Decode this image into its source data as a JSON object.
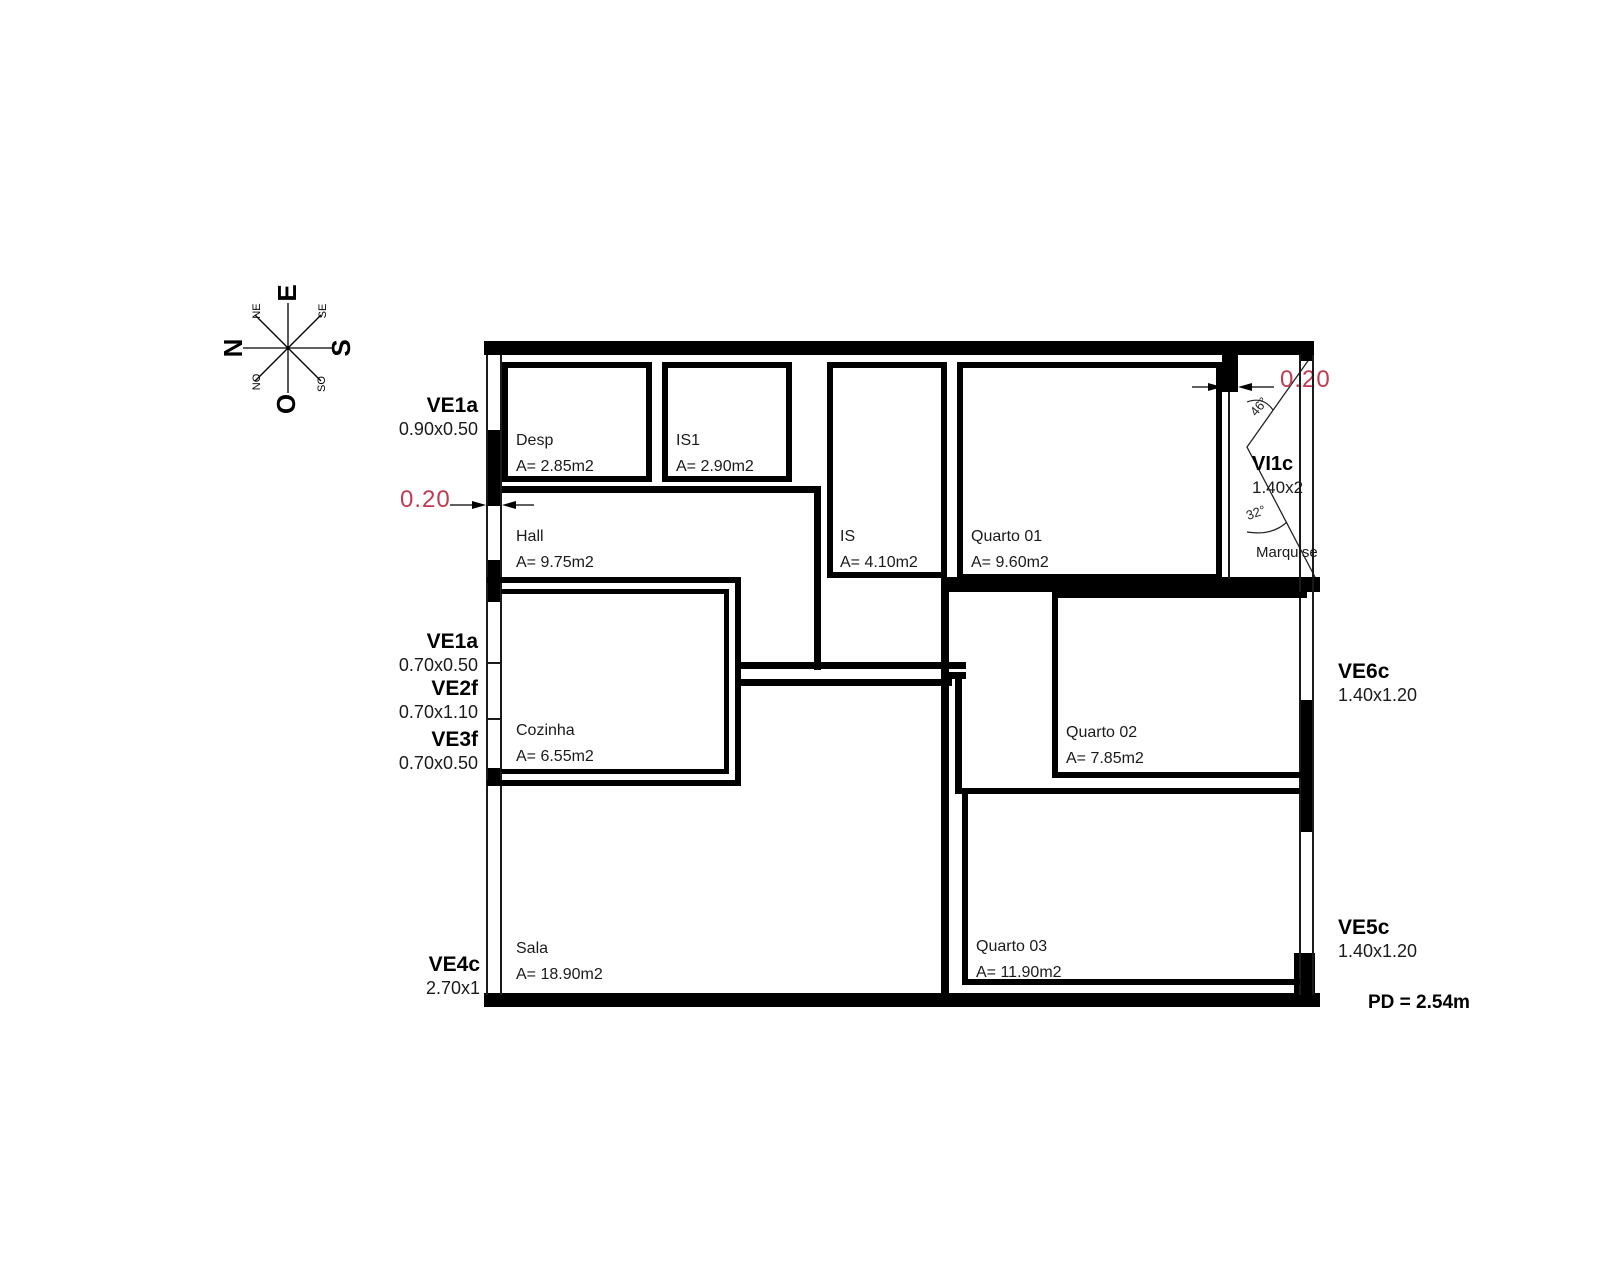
{
  "title": "floor-plan",
  "compass": {
    "n": "N",
    "e": "E",
    "s": "S",
    "o": "O",
    "ne": "NE",
    "se": "SE",
    "no": "NO",
    "so": "SO"
  },
  "rooms": [
    {
      "name": "Desp",
      "area": "A= 2.85m2"
    },
    {
      "name": "IS1",
      "area": "A= 2.90m2"
    },
    {
      "name": "IS",
      "area": "A= 4.10m2"
    },
    {
      "name": "Quarto 01",
      "area": "A= 9.60m2"
    },
    {
      "name": "Hall",
      "area": "A= 9.75m2"
    },
    {
      "name": "Cozinha",
      "area": "A= 6.55m2"
    },
    {
      "name": "Quarto 02",
      "area": "A= 7.85m2"
    },
    {
      "name": "Sala",
      "area": "A= 18.90m2"
    },
    {
      "name": "Quarto 03",
      "area": "A= 11.90m2"
    },
    {
      "name": "Marquise",
      "area": ""
    }
  ],
  "windows": [
    {
      "code": "VE1a",
      "size": "0.90x0.50"
    },
    {
      "code": "VE1a",
      "size": "0.70x0.50"
    },
    {
      "code": "VE2f",
      "size": "0.70x1.10"
    },
    {
      "code": "VE3f",
      "size": "0.70x0.50"
    },
    {
      "code": "VE4c",
      "size": "2.70x1"
    },
    {
      "code": "VI1c",
      "size": "1.40x2"
    },
    {
      "code": "VE6c",
      "size": "1.40x1.20"
    },
    {
      "code": "VE5c",
      "size": "1.40x1.20"
    }
  ],
  "dimensions": {
    "wall_left": "0.20",
    "wall_right": "0.20"
  },
  "angles": {
    "upper": "46°",
    "lower": "32°"
  },
  "ceiling_height": "PD = 2.54m",
  "colors": {
    "wall": "#000000",
    "dimension_red": "#c13b52"
  }
}
